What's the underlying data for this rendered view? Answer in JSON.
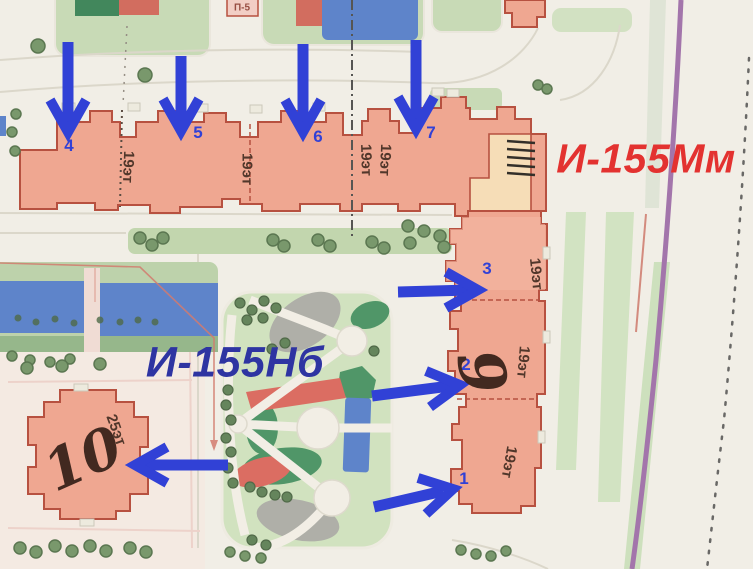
{
  "labels": {
    "series_top": "И-155Мм",
    "series_center": "И-155Нб",
    "tower9": "9",
    "tower10": "10",
    "floors19": "19эт",
    "floors25": "25эт",
    "substation": "П-5"
  },
  "arrow_numbers": [
    "1",
    "2",
    "3",
    "4",
    "5",
    "6",
    "7"
  ],
  "colors": {
    "building_fill": "#efa089",
    "building_outline": "#b0402f",
    "corner_peach": "#f6dcb4",
    "arrow_blue": "#1b2ed6",
    "series_top_red": "#e11d1d",
    "series_center_navy": "#18209c",
    "lawn_green": "#c6dcb2",
    "park_green": "#cde1bd",
    "playground_blue": "#4d79c9",
    "playground_red": "#d95f55",
    "playground_dark_green": "#3e8d5c",
    "boundary_purple": "#9a68a6"
  }
}
